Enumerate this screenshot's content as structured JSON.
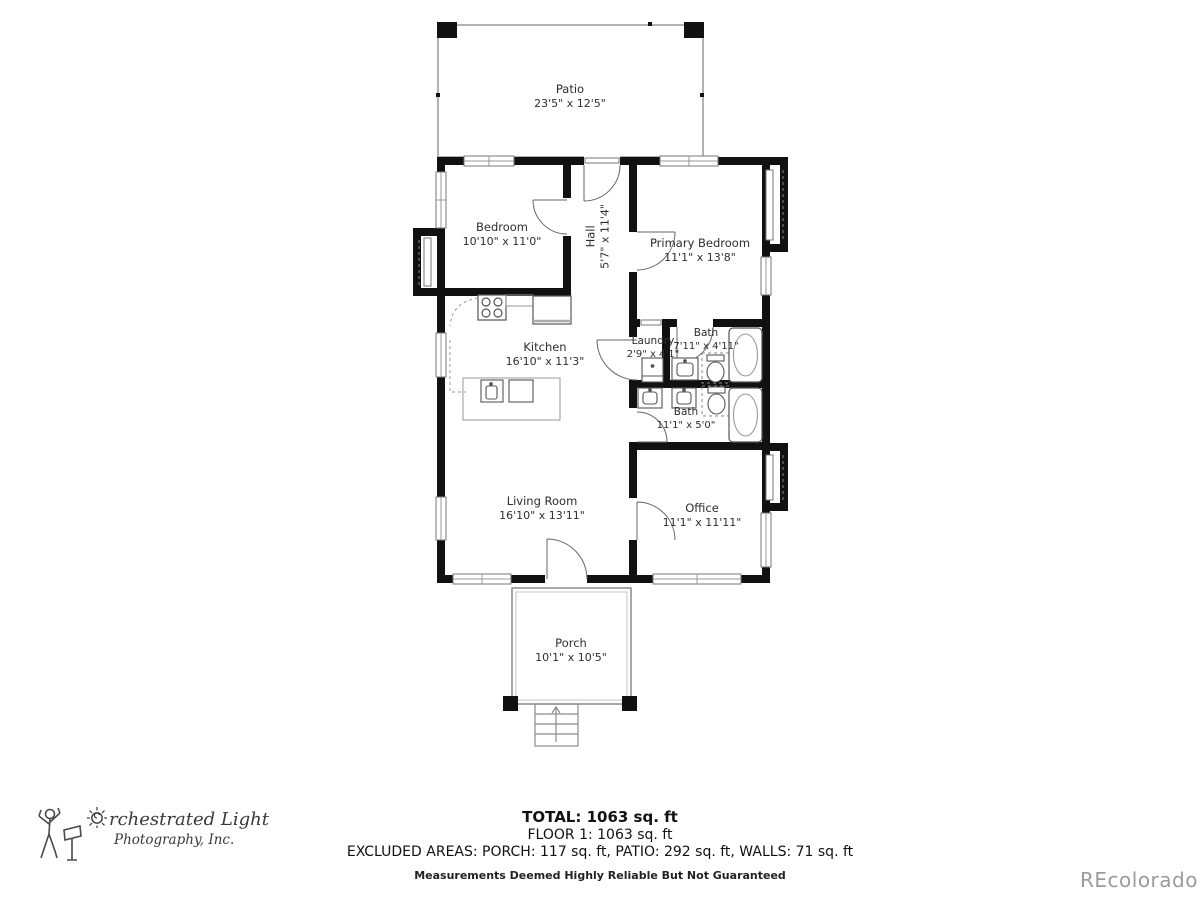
{
  "rooms": [
    {
      "id": "patio",
      "name": "Patio",
      "dims": "23'5\" x 12'5\""
    },
    {
      "id": "bedroom",
      "name": "Bedroom",
      "dims": "10'10\" x 11'0\""
    },
    {
      "id": "hall",
      "name": "Hall",
      "dims": "5'7\" x 11'4\""
    },
    {
      "id": "primary-bedroom",
      "name": "Primary Bedroom",
      "dims": "11'1\" x 13'8\""
    },
    {
      "id": "kitchen",
      "name": "Kitchen",
      "dims": "16'10\" x 11'3\""
    },
    {
      "id": "laundry",
      "name": "Laundry",
      "dims": "2'9\" x 4'1\""
    },
    {
      "id": "bath-upper",
      "name": "Bath",
      "dims": "7'11\" x 4'11\""
    },
    {
      "id": "bath-lower",
      "name": "Bath",
      "dims": "11'1\" x 5'0\""
    },
    {
      "id": "living-room",
      "name": "Living Room",
      "dims": "16'10\" x 13'11\""
    },
    {
      "id": "office",
      "name": "Office",
      "dims": "11'1\" x 11'11\""
    },
    {
      "id": "porch",
      "name": "Porch",
      "dims": "10'1\" x 10'5\""
    }
  ],
  "footer": {
    "total": "TOTAL: 1063 sq. ft",
    "floor": "FLOOR 1: 1063 sq. ft",
    "excluded": "EXCLUDED AREAS: PORCH: 117 sq. ft, PATIO: 292 sq. ft, WALLS: 71 sq. ft",
    "disclaimer": "Measurements Deemed Highly Reliable But Not Guaranteed"
  },
  "logo": {
    "line1": "rchestrated Light",
    "line2": "Photography, Inc."
  },
  "watermark": "REcolorado",
  "colors": {
    "wall": "#111111",
    "thin_line": "#999999",
    "fixture": "#555555",
    "text": "#2e2e2e",
    "watermark": "#9b9b9b"
  }
}
